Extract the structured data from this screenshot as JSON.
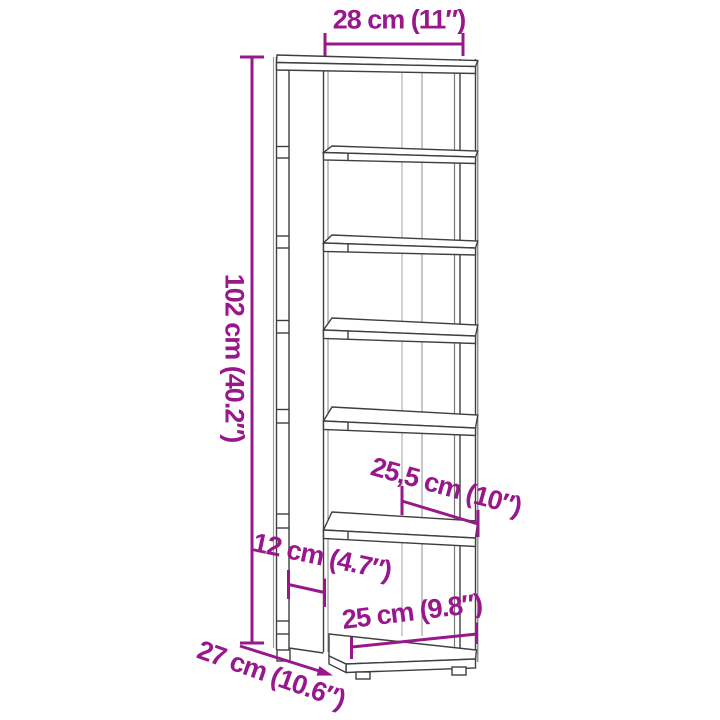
{
  "diagram": {
    "type": "product-dimension-diagram",
    "subject": "shoe rack line drawing",
    "shelf_count": 7,
    "annotations": {
      "width": "28 cm (11″)",
      "height": "102 cm (40.2″)",
      "shelf_width": "25,5 cm (10″)",
      "side_depth": "12 cm (4.7″)",
      "base_width": "25 cm (9.8″)",
      "depth": "27 cm (10.6″)"
    },
    "colors": {
      "annotation": "#98188C",
      "outline": "#3F3F3F",
      "background": "#FFFFFF"
    }
  }
}
